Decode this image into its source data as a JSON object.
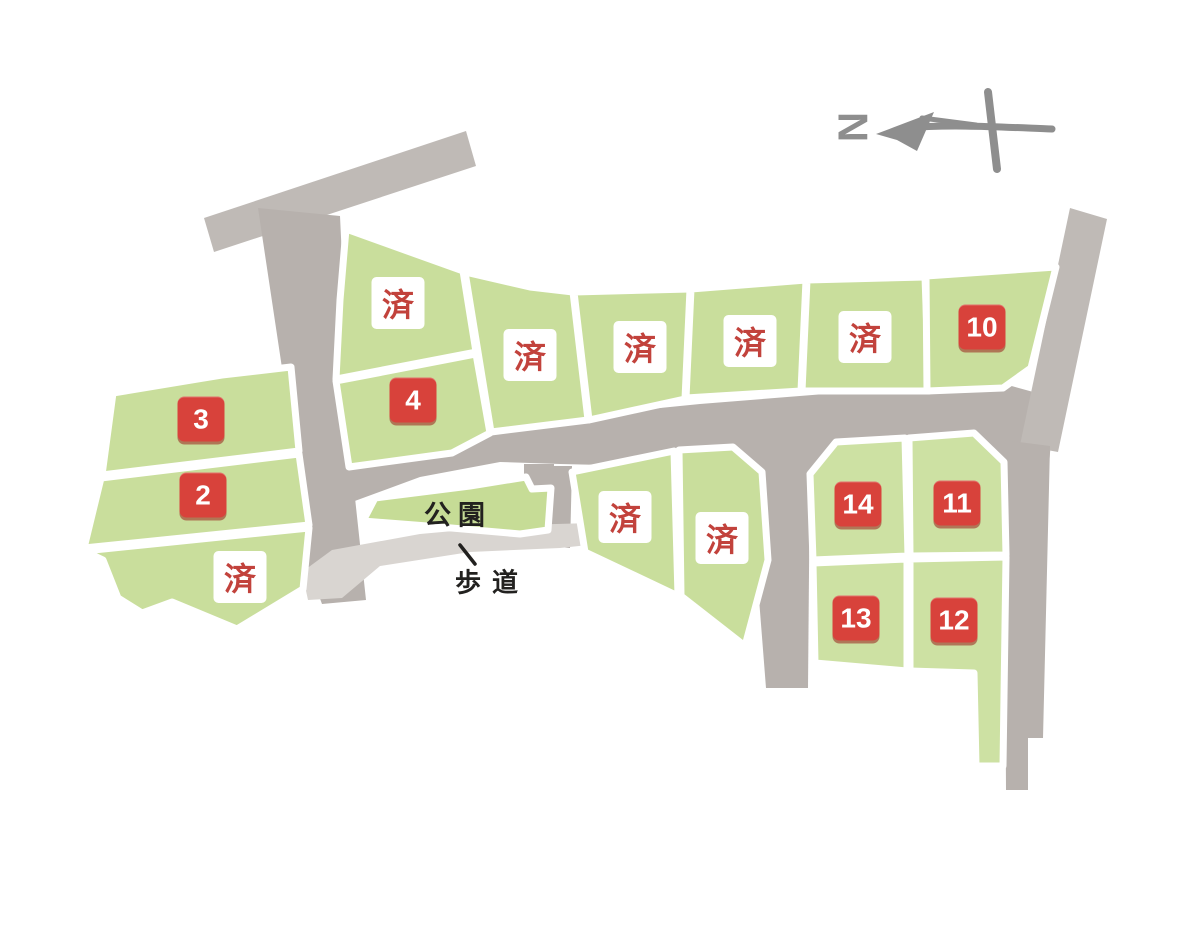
{
  "map": {
    "compass": {
      "label": "N"
    },
    "park": {
      "label": "公園"
    },
    "sidewalk": {
      "label": "歩道"
    },
    "sold_marker_text": "済",
    "lots": [
      {
        "id": "top-row-rear",
        "label": "済",
        "status": "sold"
      },
      {
        "id": "lot-4",
        "label": "4",
        "status": "available"
      },
      {
        "id": "top-row-2",
        "label": "済",
        "status": "sold"
      },
      {
        "id": "top-row-3",
        "label": "済",
        "status": "sold"
      },
      {
        "id": "top-row-4",
        "label": "済",
        "status": "sold"
      },
      {
        "id": "top-row-5",
        "label": "済",
        "status": "sold"
      },
      {
        "id": "lot-10",
        "label": "10",
        "status": "available"
      },
      {
        "id": "lot-3",
        "label": "3",
        "status": "available"
      },
      {
        "id": "lot-2",
        "label": "2",
        "status": "available"
      },
      {
        "id": "west-sold",
        "label": "済",
        "status": "sold"
      },
      {
        "id": "center-sold-1",
        "label": "済",
        "status": "sold"
      },
      {
        "id": "center-sold-2",
        "label": "済",
        "status": "sold"
      },
      {
        "id": "lot-14",
        "label": "14",
        "status": "available"
      },
      {
        "id": "lot-11",
        "label": "11",
        "status": "available"
      },
      {
        "id": "lot-13",
        "label": "13",
        "status": "available"
      },
      {
        "id": "lot-12",
        "label": "12",
        "status": "available"
      }
    ],
    "colors": {
      "parcel_green": "#c9de9c",
      "road_grey": "#b7b1ad",
      "sidewalk_grey": "#d9d5d1",
      "badge_red": "#d8423b",
      "sold_text_red": "#c2423c",
      "label_black": "#22211f",
      "compass_grey": "#8e8e8e"
    }
  }
}
